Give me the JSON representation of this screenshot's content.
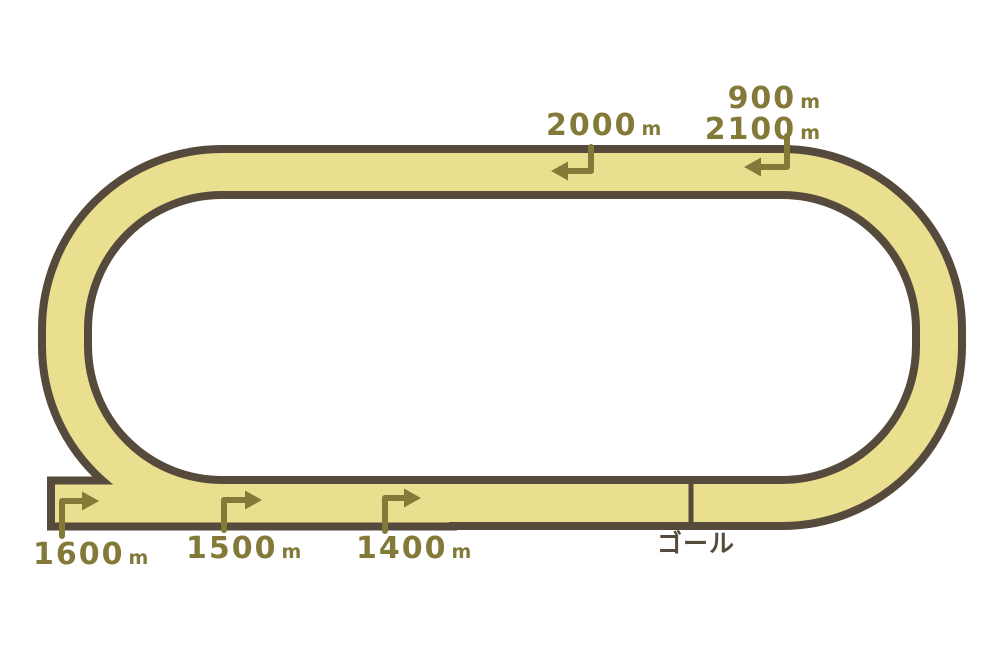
{
  "colors": {
    "background": "#FFFFFF",
    "track_fill": "#E9DF8F",
    "track_outline": "#564A3C",
    "marker_text": "#837A39"
  },
  "markers": {
    "top": [
      {
        "value": "2000",
        "unit": "m"
      },
      {
        "value": "900",
        "unit": "m"
      },
      {
        "value": "2100",
        "unit": "m"
      }
    ],
    "bottom": [
      {
        "value": "1600",
        "unit": "m"
      },
      {
        "value": "1500",
        "unit": "m"
      },
      {
        "value": "1400",
        "unit": "m"
      }
    ],
    "goal": "ゴール"
  }
}
